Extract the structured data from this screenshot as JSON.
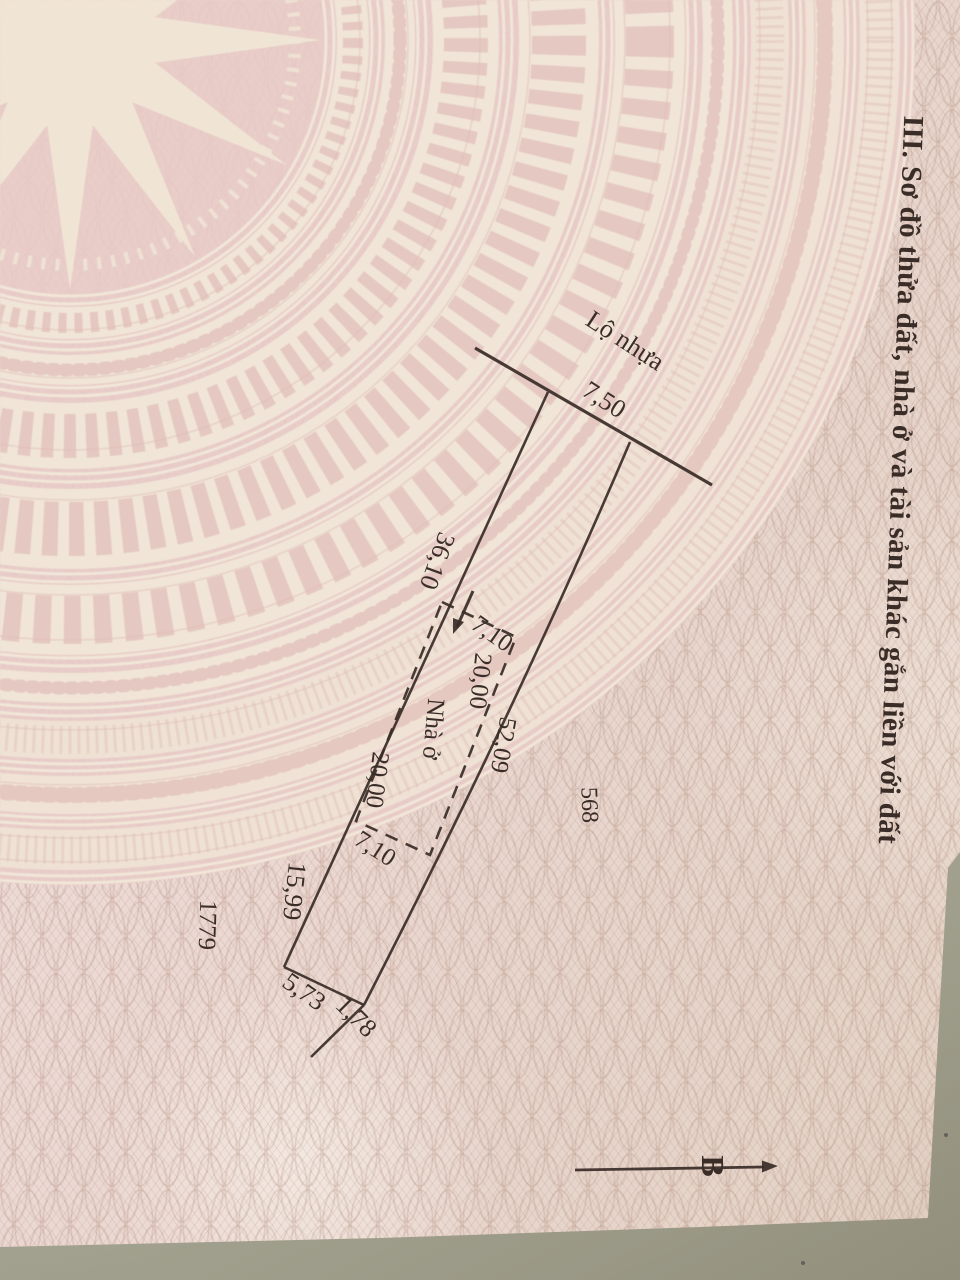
{
  "page": {
    "section_title": "III. Sơ đồ thửa đất, nhà ở và tài sản khác gắn liền với đất"
  },
  "diagram": {
    "road_label": "Lộ nhựa",
    "house_label": "Nhà ở",
    "north_label": "B",
    "adjacent_parcel_right": "568",
    "adjacent_parcel_left": "1779",
    "dimensions": {
      "road_frontage": "7,50",
      "left_side_upper": "36,10",
      "left_side_lower": "15,99",
      "right_side": "52,09",
      "house_width_top": "7,10",
      "house_width_bottom": "7,10",
      "house_length_right": "20,00",
      "house_length_left": "20,00",
      "bottom_edge": "5,73",
      "boundary_extension": "1,78"
    }
  },
  "colors": {
    "paper_pink": "#ecd9d4",
    "paper_beige": "#e3d2c5",
    "drum_cream": "#f2e8d9",
    "drum_pink": "#e8cbc6",
    "ink": "#3a2d28",
    "table_surface": "#a9a795"
  }
}
